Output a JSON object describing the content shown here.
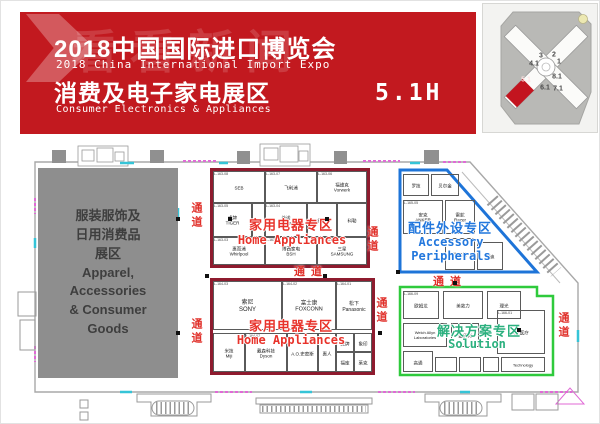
{
  "banner": {
    "bg_color": "#c2191f",
    "watermark_text": "看看新闻",
    "title_cn": "2018中国国际进口博览会",
    "title_en": "2018 China International Import Expo",
    "zone_cn": "消费及电子家电展区",
    "zone_en": "Consumer Electronics & Appliances",
    "hall": "5.1H"
  },
  "minimap": {
    "highlight_color": "#c3141f",
    "halls": [
      {
        "label": "3",
        "x": 58,
        "y": 52
      },
      {
        "label": "2",
        "x": 71,
        "y": 51
      },
      {
        "label": "4.1",
        "x": 51,
        "y": 60
      },
      {
        "label": "1",
        "x": 76,
        "y": 58
      },
      {
        "label": "5.1",
        "x": 43,
        "y": 76,
        "hl": true
      },
      {
        "label": "8.1",
        "x": 74,
        "y": 73
      },
      {
        "label": "6.1",
        "x": 62,
        "y": 84
      },
      {
        "label": "7.1",
        "x": 75,
        "y": 85
      }
    ]
  },
  "plan": {
    "apparel_zone": {
      "text": "服装服饰及\n日用消费品\n展区\nApparel,\nAccessories\n& Consumer\nGoods"
    },
    "zones": [
      {
        "name_cn": "家用电器专区",
        "name_en": "Home Appliances",
        "accent": "#e8332b",
        "border": "#8e1b2e",
        "rect": [
          210,
          168,
          160,
          100
        ],
        "label": {
          "cn": [
            291,
            224
          ],
          "en": [
            292,
            241
          ]
        },
        "booths": [
          {
            "r": [
              213,
              171,
              52,
              32
            ],
            "id": "L-163-08",
            "n": "SEB"
          },
          {
            "r": [
              265,
              171,
              52,
              32
            ],
            "id": "L-163-07",
            "n": "飞利浦"
          },
          {
            "r": [
              317,
              171,
              50,
              32
            ],
            "id": "L-163-06",
            "n": "福维克\nVorwerk"
          },
          {
            "r": [
              213,
              203,
              39,
              34
            ],
            "id": "L-163-05",
            "n": "虎牌\nTIGER"
          },
          {
            "r": [
              252,
              203,
              13,
              34
            ],
            "id": "",
            "n": ""
          },
          {
            "r": [
              265,
              203,
              42,
              34
            ],
            "id": "L-163-04",
            "n": "美诺\nMiele"
          },
          {
            "r": [
              307,
              203,
              30,
              34
            ],
            "id": "",
            "n": "德龙"
          },
          {
            "r": [
              337,
              203,
              30,
              34
            ],
            "id": "",
            "n": "科勒"
          },
          {
            "r": [
              213,
              237,
              52,
              28
            ],
            "id": "L-163-03",
            "n": "惠而浦\nWhirlpool"
          },
          {
            "r": [
              265,
              237,
              52,
              28
            ],
            "id": "L-163-02",
            "n": "博西家电\nBSH"
          },
          {
            "r": [
              317,
              237,
              50,
              28
            ],
            "id": "L-163-01",
            "n": "三星\nSAMSUNG"
          }
        ]
      },
      {
        "name_cn": "家用电器专区",
        "name_en": "Home Appliances",
        "accent": "#e8332b",
        "border": "#8e1b2e",
        "rect": [
          210,
          278,
          165,
          97
        ],
        "label": {
          "cn": [
            291,
            325
          ],
          "en": [
            291,
            341
          ]
        },
        "booths": [
          {
            "r": [
              213,
              281,
              69,
              49
            ],
            "id": "L-164-03",
            "n": "索尼\nSONY",
            "fs": 6
          },
          {
            "r": [
              282,
              281,
              54,
              49
            ],
            "id": "L-164-02",
            "n": "富士康\nFOXCONN",
            "fs": 5.5
          },
          {
            "r": [
              336,
              281,
              36,
              49
            ],
            "id": "L-164-01",
            "n": "松下\nPanasonic",
            "fs": 5
          },
          {
            "r": [
              213,
              333,
              32,
              39
            ],
            "id": "",
            "n": "米技\nMiji"
          },
          {
            "r": [
              245,
              333,
              42,
              39
            ],
            "id": "L-164-07",
            "n": "戴森科技\nDyson"
          },
          {
            "r": [
              287,
              333,
              31,
              39
            ],
            "id": "",
            "n": "A.O.史密斯"
          },
          {
            "r": [
              318,
              333,
              18,
              39
            ],
            "id": "",
            "n": "惠人"
          },
          {
            "r": [
              336,
              333,
              18,
              19
            ],
            "id": "",
            "n": "虎牌"
          },
          {
            "r": [
              354,
              333,
              18,
              19
            ],
            "id": "",
            "n": "象印"
          },
          {
            "r": [
              336,
              352,
              18,
              20
            ],
            "id": "",
            "n": "福库"
          },
          {
            "r": [
              354,
              352,
              18,
              20
            ],
            "id": "",
            "n": "莱克"
          }
        ]
      },
      {
        "name_cn": "配件外设专区",
        "name_en": "Accessory\nPeripherals",
        "accent": "#2277dd",
        "border": "#1e74d8",
        "shape_ref": "blue-poly",
        "label": {
          "cn": [
            450,
            227
          ],
          "en": [
            451,
            250
          ]
        },
        "booths": [
          {
            "r": [
              403,
              174,
              26,
              22
            ],
            "id": "",
            "n": "罗技"
          },
          {
            "r": [
              431,
              174,
              28,
              22
            ],
            "id": "",
            "n": "贝尔金"
          },
          {
            "r": [
              403,
              200,
              40,
              34
            ],
            "id": "L-165-05",
            "n": "安克\nANKER"
          },
          {
            "r": [
              445,
              200,
              30,
              34
            ],
            "id": "",
            "n": "雷蛇\nRazer"
          },
          {
            "r": [
              445,
              238,
              30,
              32
            ],
            "id": "",
            "n": "海盗船"
          },
          {
            "r": [
              477,
              242,
              26,
              28
            ],
            "id": "",
            "n": "闪迪"
          }
        ]
      },
      {
        "name_cn": "解决方案专区",
        "name_en": "Solution",
        "accent": "#2bb07e",
        "border": "#2fca3c",
        "shape_ref": "green-poly",
        "label": {
          "cn": [
            479,
            330
          ],
          "en": [
            477,
            345
          ]
        },
        "booths": [
          {
            "r": [
              403,
              291,
              36,
              28
            ],
            "id": "L-166-09",
            "n": "欧姆龙"
          },
          {
            "r": [
              443,
              291,
              40,
              28
            ],
            "id": "",
            "n": "美敦力"
          },
          {
            "r": [
              487,
              291,
              34,
              28
            ],
            "id": "",
            "n": "理光"
          },
          {
            "r": [
              403,
              323,
              44,
              24
            ],
            "id": "",
            "n": "Welch Allyn\nLaboratories",
            "fs": 4
          },
          {
            "r": [
              451,
              323,
              28,
              24
            ],
            "id": "",
            "n": "金佰利"
          },
          {
            "r": [
              497,
              310,
              48,
              44
            ],
            "id": "L-166-01",
            "n": "GE医疗"
          },
          {
            "r": [
              403,
              351,
              30,
              21
            ],
            "id": "",
            "n": "高通"
          },
          {
            "r": [
              435,
              357,
              22,
              15
            ],
            "id": "",
            "n": ""
          },
          {
            "r": [
              459,
              357,
              22,
              15
            ],
            "id": "",
            "n": ""
          },
          {
            "r": [
              483,
              357,
              16,
              15
            ],
            "id": "",
            "n": ""
          },
          {
            "r": [
              501,
              357,
              44,
              15
            ],
            "id": "",
            "n": "Technology",
            "fs": 4
          }
        ]
      }
    ],
    "aisles": [
      {
        "t": "通道",
        "x": 196,
        "y": 216,
        "v": true
      },
      {
        "t": "通道",
        "x": 196,
        "y": 332,
        "v": true
      },
      {
        "t": "通道",
        "x": 372,
        "y": 240,
        "v": true
      },
      {
        "t": "通道",
        "x": 381,
        "y": 311,
        "v": true
      },
      {
        "t": "通道",
        "x": 563,
        "y": 326,
        "v": true
      },
      {
        "t": "通道",
        "x": 311,
        "y": 271,
        "v": false
      },
      {
        "t": "通道",
        "x": 450,
        "y": 281,
        "v": false
      }
    ],
    "pillars": [
      [
        230,
        219
      ],
      [
        327,
        219
      ],
      [
        178,
        219
      ],
      [
        207,
        276
      ],
      [
        325,
        276
      ],
      [
        398,
        272
      ],
      [
        380,
        333
      ],
      [
        178,
        333
      ],
      [
        455,
        283
      ],
      [
        519,
        330
      ]
    ]
  }
}
